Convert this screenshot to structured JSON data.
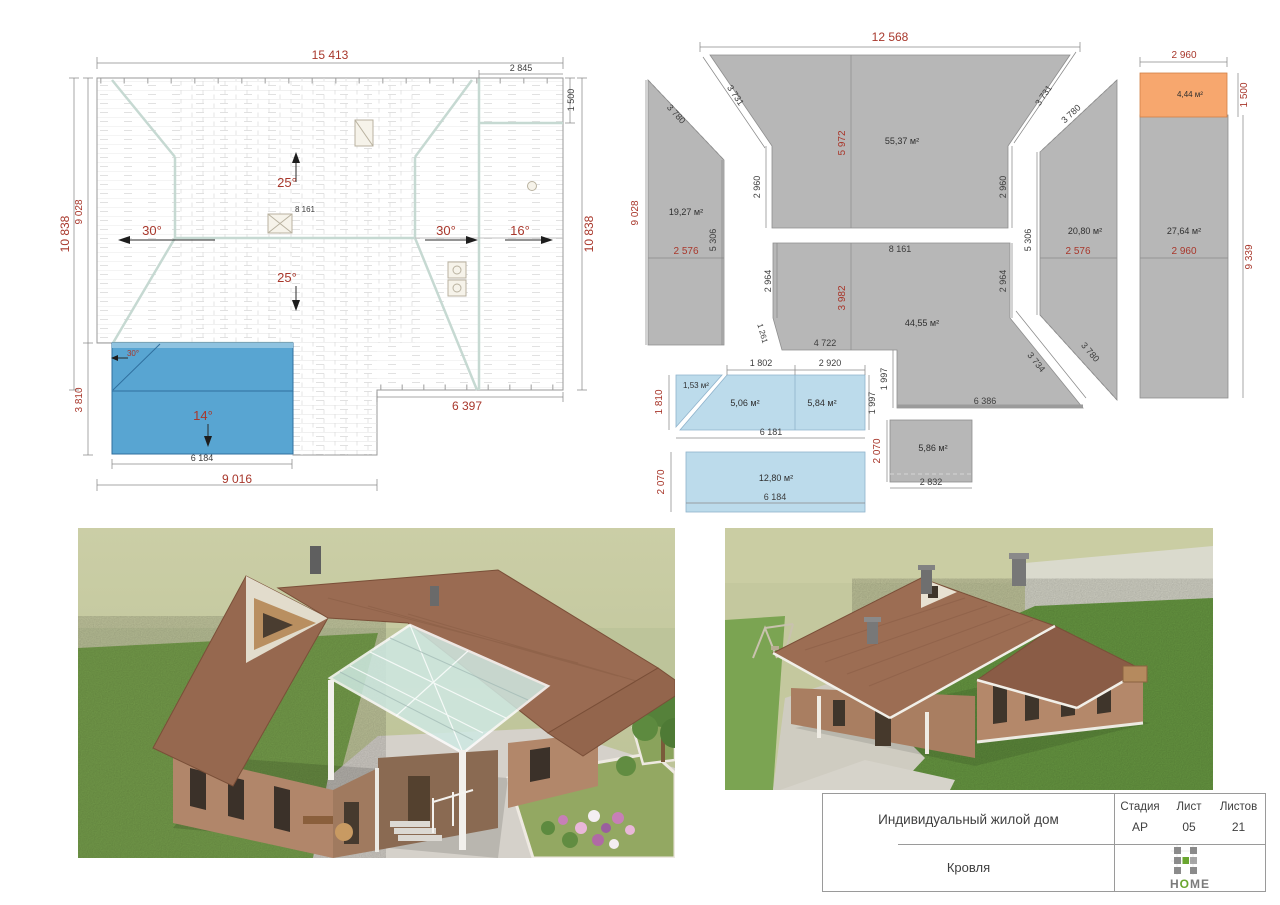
{
  "colors": {
    "dim_red": "#a8372b",
    "panel_gray": "#b7b7b7",
    "panel_orange": "#f7a76e",
    "panel_blue": "#bcdbeb",
    "plan_blue": "#58a5d2",
    "logo_green": "#6aa62f",
    "logo_gray": "#8b8b8b"
  },
  "roof_plan": {
    "dim_top": "15 413",
    "dim_top_right": "2 845",
    "dim_right_1500": "1 500",
    "dim_right_10838": "10 838",
    "dim_left_10838": "10 838",
    "dim_left_9028": "9 028",
    "dim_left_3810": "3 810",
    "dim_bottom_6184": "6 184",
    "dim_bottom_9016": "9 016",
    "dim_bottom_6397": "6 397",
    "ridge_label": "8 161",
    "angle_top": "25°",
    "angle_left": "30°",
    "angle_right": "30°",
    "angle_right2": "16°",
    "angle_bottom": "25°",
    "angle_canopy_hip": "30°",
    "angle_canopy": "14°"
  },
  "panel_layout": {
    "dim_top": "12 568",
    "areas": {
      "left": "19,27 м²",
      "top": "55,37 м²",
      "right": "20,80 м²",
      "far_right": "27,64 м²",
      "orange": "4,44 м²",
      "bottom": "44,55 м²",
      "tri": "1,53 м²",
      "blue_a": "5,06 м²",
      "blue_b": "5,84 м²",
      "blue_c": "12,80 м²",
      "gray_small": "5,86 м²"
    },
    "red": {
      "left_9028": "9 028",
      "mid_5972": "5 972",
      "left_2576": "2 576",
      "right_2576": "2 576",
      "orange_2960": "2 960",
      "orange_1500": "1 500",
      "fr_2960": "2 960",
      "fr_9339": "9 339",
      "mid_3982": "3 982",
      "blue_1810": "1 810",
      "blue_2070": "2 070",
      "gray_2070": "2 070"
    },
    "black": {
      "l3780": "3 780",
      "l3731": "3 731",
      "l2960": "2 960",
      "l5306": "5 306",
      "r3731": "3 731",
      "r3780a": "3 780",
      "r2960": "2 960",
      "r5306": "5 306",
      "c8161": "8 161",
      "c2964a": "2 964",
      "c2964b": "2 964",
      "c1261": "1 261",
      "c4722": "4 722",
      "c1997": "1 997",
      "c6386": "6 386",
      "c3734": "3 734",
      "r3780b": "3 780",
      "b1802": "1 802",
      "b2920": "2 920",
      "b1997": "1 997",
      "b6181": "6 181",
      "b6184": "6 184",
      "g2832": "2 832"
    }
  },
  "title_block": {
    "project": "Индивидуальный жилой дом",
    "col_stage": "Стадия",
    "col_sheet": "Лист",
    "col_sheets": "Листов",
    "stage": "АР",
    "sheet": "05",
    "sheets": "21",
    "drawing": "Кровля",
    "logo_h": "H",
    "logo_o": "O",
    "logo_me": "ME"
  }
}
